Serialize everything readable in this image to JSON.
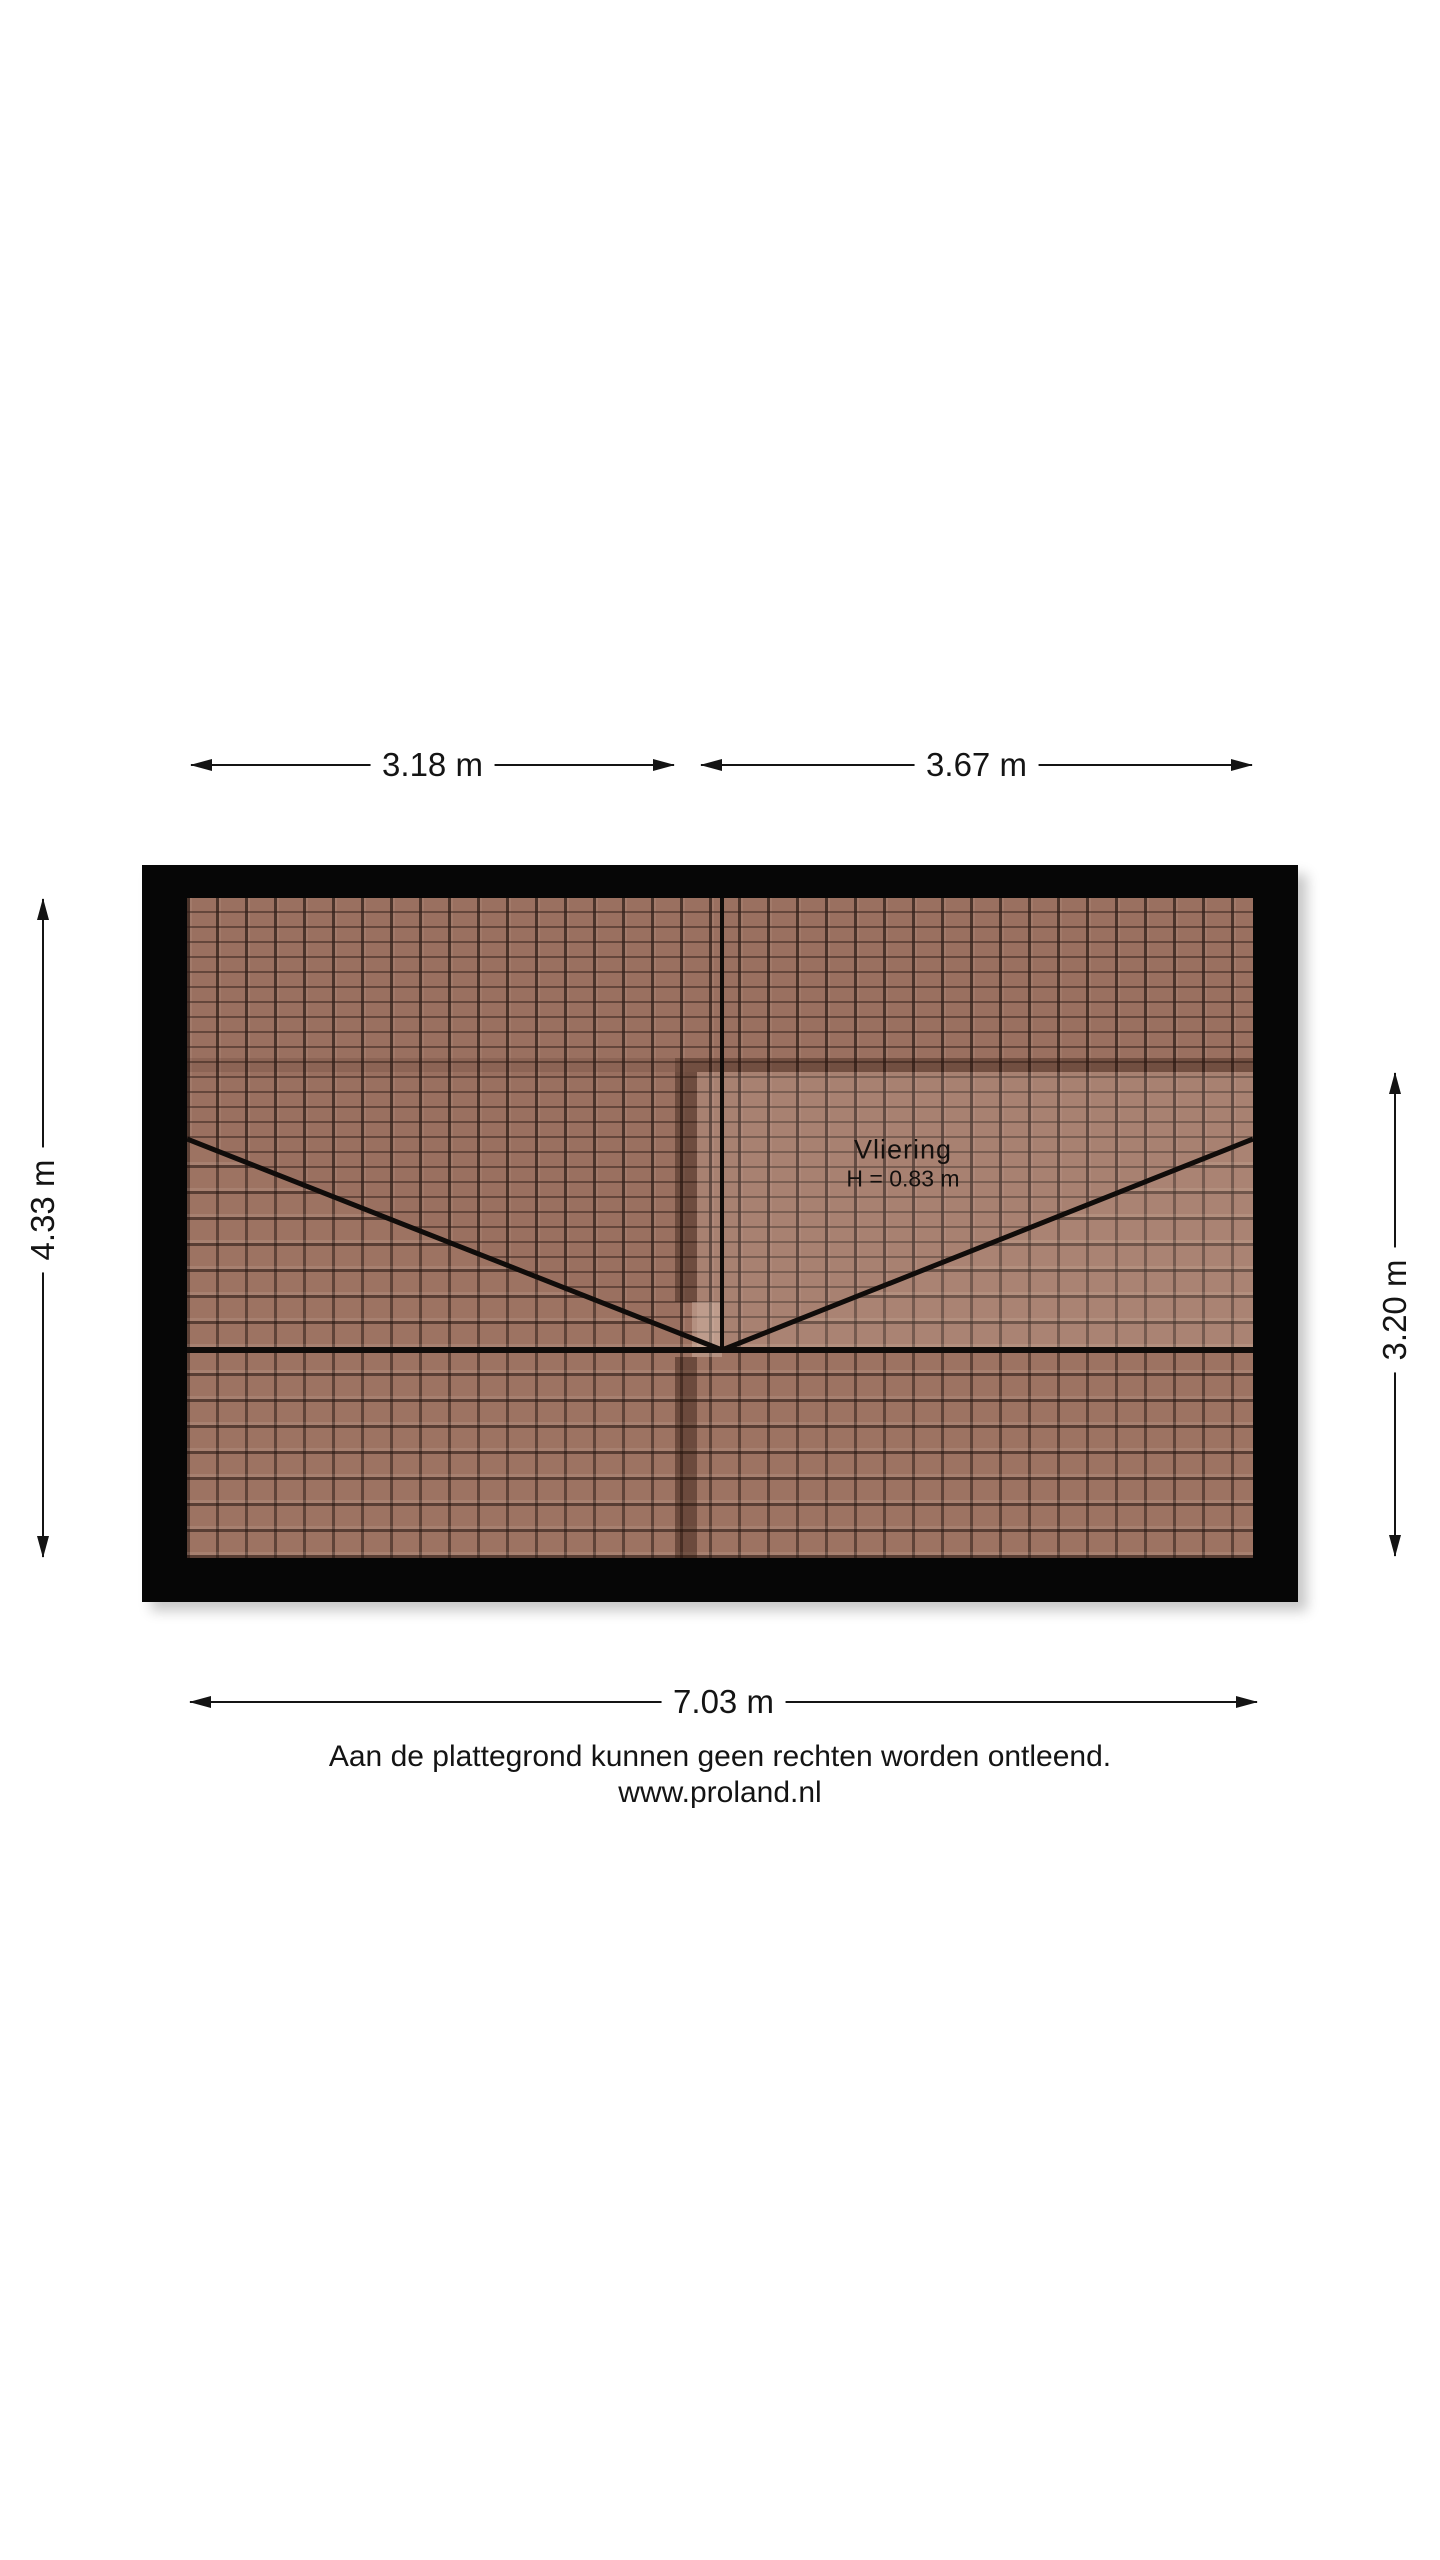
{
  "floorplan": {
    "room": {
      "label": "Vliering",
      "height_note": "H = 0.83 m"
    },
    "dimensions": {
      "top_left": "3.18 m",
      "top_right": "3.67 m",
      "left": "4.33 m",
      "right": "3.20 m",
      "bottom": "7.03 m"
    },
    "footer": {
      "disclaimer": "Aan de plattegrond kunnen geen rechten worden ontleend.",
      "website": "www.proland.nl"
    },
    "colors": {
      "wall": "#060606",
      "tile_base": "#9a7060",
      "tile_joint": "#33221a",
      "dimension_line": "#141414"
    }
  }
}
